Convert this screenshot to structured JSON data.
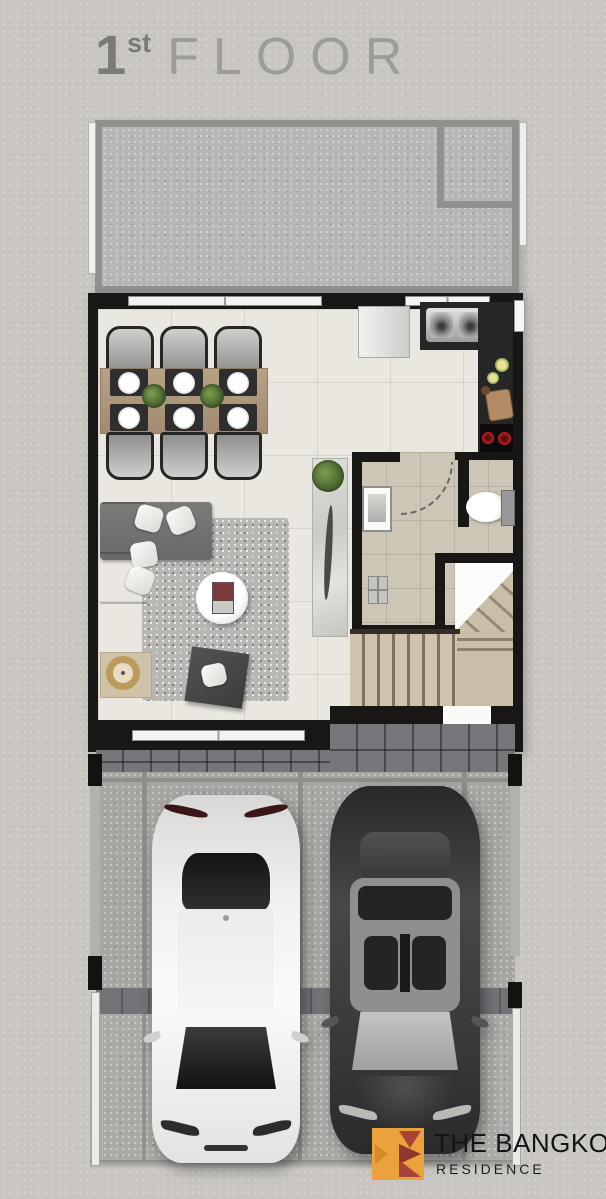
{
  "title": {
    "number": "1",
    "ordinal": "st",
    "word": "FLOOR"
  },
  "brand": {
    "name": "THE BANGKOK",
    "subtitle": "RESIDENCE"
  },
  "colors": {
    "page_background": "#c9c6c1",
    "wall_black": "#181715",
    "interior_tile": "#eae7e0",
    "terrace_concrete": "#b5b7b4",
    "bathroom_tile": "#cdc5b6",
    "stair_wood": "#c9bfa6",
    "garage_tile": "#76767a",
    "carport_concrete": "#a8a6a2",
    "logo_orange": "#e9a23c",
    "logo_red": "#a8423a"
  },
  "floorplan": {
    "floor_label": "1st Floor",
    "rooms": [
      "terrace",
      "dining-area",
      "kitchen",
      "living-area",
      "bathroom",
      "staircase",
      "carport-garage",
      "driveway"
    ],
    "furniture_and_fixtures": [
      "dining-table-for-six",
      "dining-chairs",
      "table-plants",
      "refrigerator",
      "double-sink",
      "two-burner-stove",
      "l-shaped-sofa",
      "throw-pillows",
      "area-rug",
      "round-coffee-table",
      "ottoman",
      "gold-pouf",
      "console-with-plant",
      "washbasin",
      "toilet",
      "shower-drain",
      "stairs-up",
      "white-car",
      "dark-gray-car"
    ]
  }
}
